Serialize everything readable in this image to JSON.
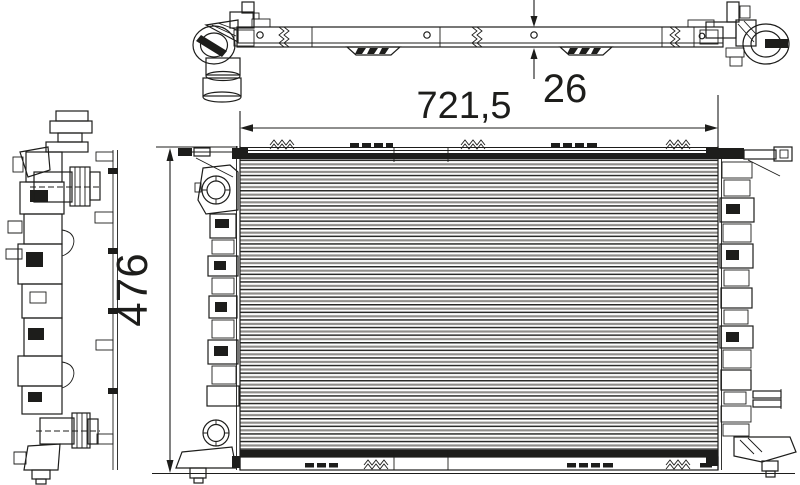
{
  "drawing": {
    "type": "radiator-three-view-technical-drawing",
    "colors": {
      "line": "#1d1d1b",
      "fin_gray": "#8f8d8a",
      "background": "#ffffff"
    },
    "dimensions": {
      "width": {
        "label": "721,5"
      },
      "depth": {
        "label": "26"
      },
      "height": {
        "label": "476"
      }
    }
  }
}
